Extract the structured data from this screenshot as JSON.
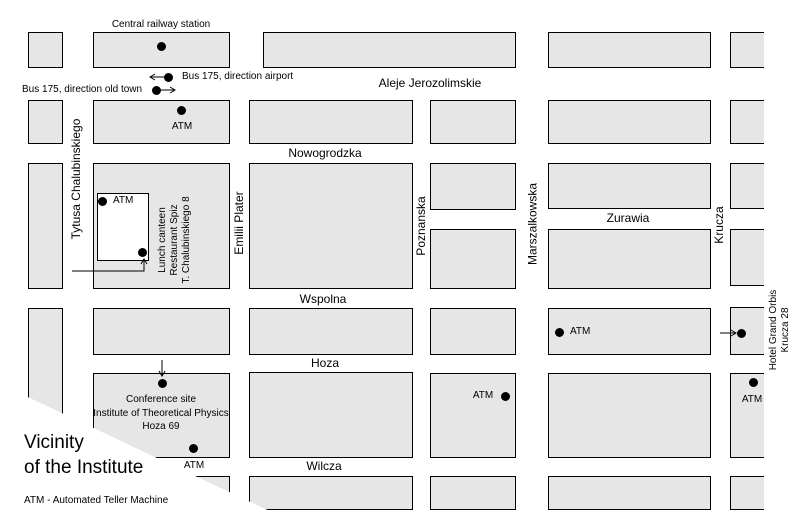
{
  "map": {
    "title_line1": "Vicinity",
    "title_line2": "of the Institute",
    "legend": "ATM - Automated Teller Machine"
  },
  "streets": {
    "horizontal": {
      "aleje_jerozolimskie": "Aleje Jerozolimskie",
      "nowogrodzka": "Nowogrodzka",
      "zurawia": "Zurawia",
      "wspolna": "Wspolna",
      "hoza": "Hoza",
      "wilcza": "Wilcza"
    },
    "vertical": {
      "tytusa_chalubinskiego": "Tytusa Chalubinskiego",
      "emilii_plater": "Emilii Plater",
      "poznanska": "Poznanska",
      "marszalkowska": "Marszalkowska",
      "krucza": "Krucza"
    }
  },
  "pois": {
    "central_railway_station": "Central railway station",
    "bus_airport": "Bus 175, direction airport",
    "bus_old_town": "Bus 175, direction old town",
    "atm_label": "ATM",
    "lunch_canteen": {
      "line1": "Lunch canteen",
      "line2": "Restaurant Spiz",
      "line3": "T. Chalubinskiego 8"
    },
    "conference_site": {
      "line1": "Conference site",
      "line2": "Institute of Theoretical Physics",
      "line3": "Hoza 69"
    },
    "hotel": {
      "line1": "Hotel Grand Orbis",
      "line2": "Krucza 28"
    }
  },
  "colors": {
    "block_fill": "#e6e6e6",
    "line": "#000000",
    "background": "#ffffff"
  }
}
